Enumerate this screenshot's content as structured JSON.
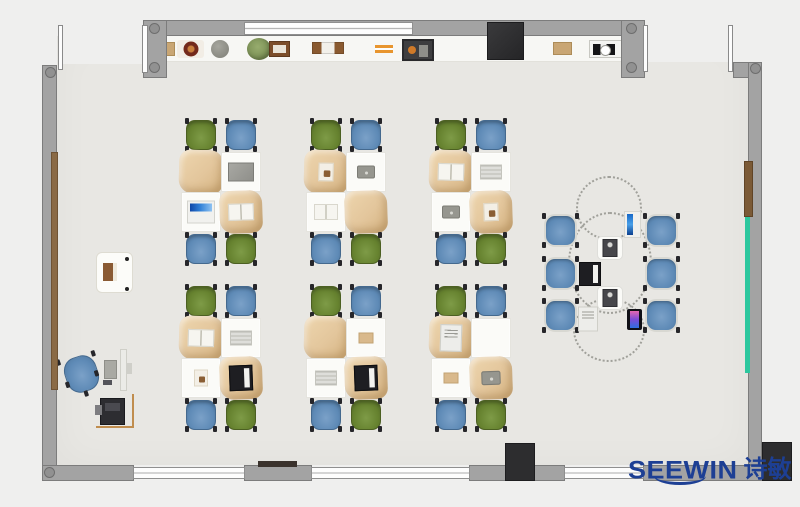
{
  "meta": {
    "title": "Classroom furniture top-view floor plan"
  },
  "brand": {
    "name": "SEEWIN",
    "cn": "诗敏",
    "color": "#1d3f94"
  },
  "palette": {
    "floor": "#e8e7e3",
    "exterior": "#efefee",
    "wall": "#a3a3a3",
    "wall_dark": "#7c7c7c",
    "chair_green": "#66822f",
    "chair_blue": "#5e8ab6",
    "desk_tan": "#e3c69c",
    "desk_white": "#fbfbf8",
    "accent_teal": "#2cc79e",
    "wood": "#8a6a45",
    "logo_blue": "#1d3f94"
  },
  "plan": {
    "clusters": [
      {
        "x": 181,
        "y": 120,
        "top": [
          "green",
          "blue"
        ],
        "bottom": [
          "blue",
          "green"
        ],
        "desks": [
          {
            "cover": "tan",
            "item": null
          },
          {
            "cover": "white",
            "item": "laptop_gray"
          },
          {
            "cover": "white",
            "item": "laptop_blue"
          },
          {
            "cover": "tan",
            "item": "book"
          }
        ]
      },
      {
        "x": 306,
        "y": 120,
        "top": [
          "green",
          "blue"
        ],
        "bottom": [
          "blue",
          "green"
        ],
        "desks": [
          {
            "cover": "tan",
            "item": "photo"
          },
          {
            "cover": "white",
            "item": "tablet"
          },
          {
            "cover": "white",
            "item": "book"
          },
          {
            "cover": "tan",
            "item": null
          }
        ]
      },
      {
        "x": 431,
        "y": 120,
        "top": [
          "green",
          "blue"
        ],
        "bottom": [
          "blue",
          "green"
        ],
        "desks": [
          {
            "cover": "tan",
            "item": "book"
          },
          {
            "cover": "white",
            "item": "news"
          },
          {
            "cover": "white",
            "item": "tablet"
          },
          {
            "cover": "tan",
            "item": "photo"
          }
        ]
      },
      {
        "x": 181,
        "y": 286,
        "top": [
          "green",
          "blue"
        ],
        "bottom": [
          "blue",
          "green"
        ],
        "desks": [
          {
            "cover": "tan",
            "item": "book"
          },
          {
            "cover": "white",
            "item": "news"
          },
          {
            "cover": "white",
            "item": "photo"
          },
          {
            "cover": "tan",
            "item": "laptop_black"
          }
        ]
      },
      {
        "x": 306,
        "y": 286,
        "top": [
          "green",
          "blue"
        ],
        "bottom": [
          "blue",
          "green"
        ],
        "desks": [
          {
            "cover": "tan",
            "item": null
          },
          {
            "cover": "white",
            "item": "notebook"
          },
          {
            "cover": "white",
            "item": "news"
          },
          {
            "cover": "tan",
            "item": "laptop_black"
          }
        ]
      },
      {
        "x": 431,
        "y": 286,
        "top": [
          "green",
          "blue"
        ],
        "bottom": [
          "blue",
          "green"
        ],
        "desks": [
          {
            "cover": "tan",
            "item": "laptop_white"
          },
          {
            "cover": "white",
            "item": null
          },
          {
            "cover": "white",
            "item": "notebook"
          },
          {
            "cover": "tan",
            "item": "tablet"
          }
        ]
      }
    ],
    "collab": {
      "chairs": [
        [
          544,
          214
        ],
        [
          544,
          257
        ],
        [
          544,
          299
        ],
        [
          645,
          214
        ],
        [
          645,
          257
        ],
        [
          645,
          299
        ]
      ],
      "devices": [
        {
          "t": "tabletBlue",
          "x": 624,
          "y": 211,
          "w": 17,
          "h": 27
        },
        {
          "t": "table",
          "x": 597,
          "y": 236,
          "w": 26,
          "h": 24
        },
        {
          "t": "laptop_black",
          "x": 578,
          "y": 261,
          "w": 23,
          "h": 25
        },
        {
          "t": "table",
          "x": 597,
          "y": 286,
          "w": 26,
          "h": 24
        },
        {
          "t": "laptop_white",
          "x": 577,
          "y": 306,
          "w": 21,
          "h": 25
        },
        {
          "t": "phone",
          "x": 627,
          "y": 309,
          "w": 15,
          "h": 21
        }
      ],
      "circles": [
        [
          576,
          176,
          66,
          64
        ],
        [
          568,
          212,
          84,
          102
        ],
        [
          573,
          298,
          72,
          64
        ]
      ]
    },
    "teacher": {
      "chair": [
        65,
        356
      ],
      "screen": [
        120,
        349,
        7,
        42
      ],
      "monitor": [
        104,
        360,
        13,
        19
      ],
      "side": [
        126,
        363,
        6,
        11
      ],
      "keyboard": [
        103,
        380,
        9,
        5
      ],
      "frame": [
        96,
        394,
        38,
        34
      ],
      "printer": [
        100,
        398,
        25,
        27
      ],
      "tab": [
        95,
        405,
        7,
        10
      ]
    },
    "cabinet": {
      "box": [
        96,
        252,
        37,
        41
      ],
      "item": [
        103,
        263,
        14,
        18
      ],
      "dots": [
        [
          125,
          257
        ],
        [
          125,
          287
        ]
      ]
    },
    "shelf_items": [
      {
        "t": "box",
        "x": 162,
        "y": 42,
        "w": 13,
        "h": 14
      },
      {
        "t": "bowl",
        "x": 177,
        "y": 40,
        "w": 27,
        "h": 18
      },
      {
        "t": "sphere",
        "x": 211,
        "y": 40,
        "w": 18,
        "h": 18
      },
      {
        "t": "plant",
        "x": 247,
        "y": 38,
        "w": 24,
        "h": 22
      },
      {
        "t": "frame",
        "x": 269,
        "y": 41,
        "w": 21,
        "h": 16
      },
      {
        "t": "books",
        "x": 312,
        "y": 42,
        "w": 32,
        "h": 12
      },
      {
        "t": "pencils",
        "x": 375,
        "y": 45,
        "w": 18,
        "h": 8
      },
      {
        "t": "toolbox",
        "x": 402,
        "y": 39,
        "w": 32,
        "h": 22
      },
      {
        "t": "box",
        "x": 553,
        "y": 42,
        "w": 19,
        "h": 13
      },
      {
        "t": "machine",
        "x": 589,
        "y": 40,
        "w": 38,
        "h": 18
      }
    ]
  }
}
